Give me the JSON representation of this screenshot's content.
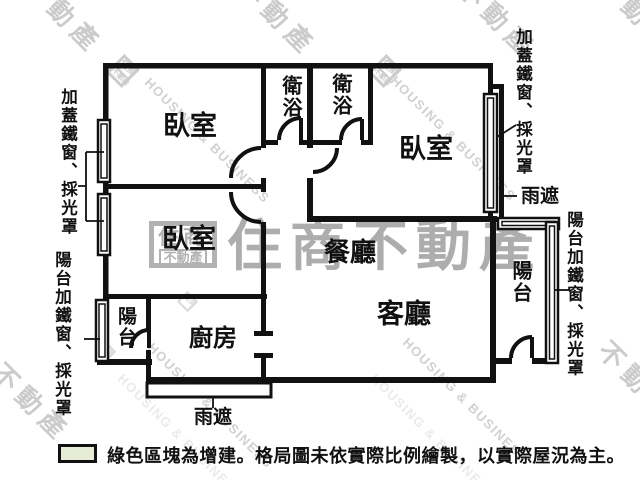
{
  "rooms": {
    "bedroom1": "臥室",
    "bedroom2": "臥室",
    "bedroom3": "臥室",
    "bath1": "衛浴",
    "bath2": "衛浴",
    "dining": "餐廳",
    "living": "客廳",
    "kitchen": "廚房",
    "balconyLeft": "陽台",
    "balconyRight": "陽台"
  },
  "annotations": {
    "leftTop": "加蓋鐵窗、採光罩",
    "leftBottom": "陽台加鐵窗、採光罩",
    "rightTop": "加蓋鐵窗、採光罩",
    "rightBottom": "陽台加鐵窗、採光罩",
    "rainRight": "雨遮",
    "rainBottom": "雨遮"
  },
  "legend": {
    "text": "綠色區塊為增建。格局圖未依實際比例繪製，以實際屋況為主。",
    "swatchColor": "#e7ecd6"
  },
  "watermark": {
    "brand": "住商不動產",
    "logoTop": "住商",
    "logoBottom": "不動產",
    "diagonalCn": "不動產",
    "diagonalEn": "HOUSING & BUSINESS",
    "color": "#b5b5b5"
  }
}
